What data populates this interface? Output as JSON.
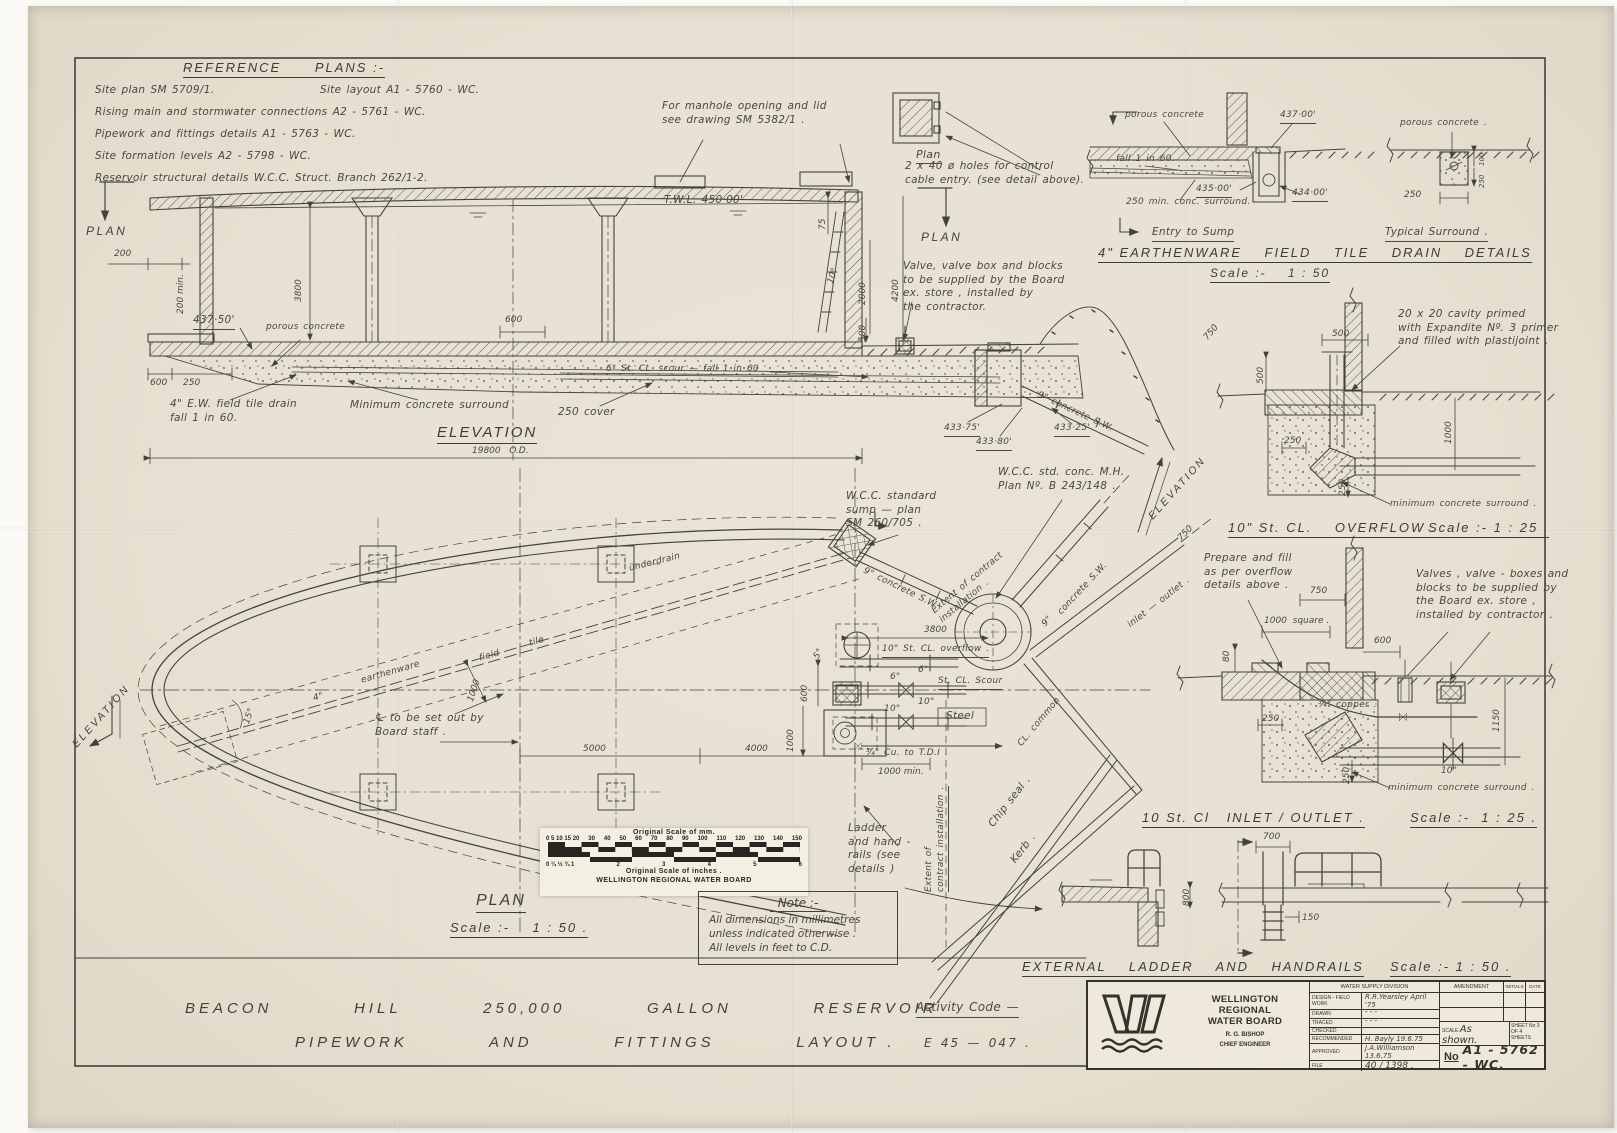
{
  "ref": {
    "title": "REFERENCE      PLANS :-",
    "r1a": "Site   plan      SM  5709/1.",
    "r1b": "Site   layout    A1 - 5760 - WC.",
    "r2": "Rising   main   and   stormwater   connections      A2 - 5761 - WC.",
    "r3": "Pipework   and   fittings   details      A1 - 5763 - WC.",
    "r4": "Site   formation   levels     A2 - 5798 - WC.",
    "r5": "Reservoir   structural   details     W.C.C.   Struct. Branch   262/1-2."
  },
  "top": {
    "manhole_note": "For  manhole  opening  and  lid\nsee  drawing  SM 5382/1 .",
    "plan_small": "Plan",
    "cable_note": "2 x 40 ø  holes  for  control\ncable  entry. (see  detail  above).",
    "plan_left": "PLAN",
    "plan_right": "PLAN"
  },
  "elev": {
    "twl": "T.W.L.   450·00'",
    "d200": "200",
    "d200min": "200 min.",
    "d3800": "3800",
    "lvl4375": "437·50'",
    "porous": "porous    concrete",
    "d600": "600",
    "d250": "250",
    "d600b": "600",
    "tile_note": "4\" E.W.  field  tile  drain\nfall    1 in 60.",
    "surround": "Minimum    concrete    surround",
    "cover": "250   cover",
    "scour": "6\"   St. CL.  scour  —  fall   1 in 60",
    "d75": "75",
    "d10": "10°",
    "d2000": "2000",
    "d4200": "4200",
    "d500": "500",
    "valve_note": "Valve, valve box  and  blocks\nto  be  supplied  by  the  Board\nex.  store ,  installed  by\nthe   contractor.",
    "l43375": "433·75'",
    "l43380": "433·80'",
    "l43325": "433·25'",
    "sw9": "9\" concrete  S.W.",
    "title": "ELEVATION",
    "od": "19800   O.D."
  },
  "tile": {
    "porous1": "porous  concrete",
    "l437": "437·00'",
    "fall": "fall 1 in 60",
    "l435": "435·00'",
    "surround": "250 min. conc. surround.",
    "l434": "434·00'",
    "d250": "250",
    "porous2": "porous  concrete .",
    "d100": "100",
    "d250b": "250",
    "entry": "Entry   to   Sump",
    "typical": "Typical    Surround .",
    "title": "4\" EARTHENWARE    FIELD    TILE    DRAIN    DETAILS",
    "scale": "Scale :-    1 : 50"
  },
  "mh": {
    "sump": "W.C.C.   standard\nsump  —  plan\nSM 260/705 .",
    "mh": "W.C.C.    std.   conc. M.H.\nPlan   Nº.  B 243/148 ."
  },
  "ovf": {
    "cavity": "20  x  20  cavity  primed\nwith  Expandite  Nº. 3  primer\nand  filled  with  plastijoint .",
    "d500h": "500",
    "d500v": "500",
    "d250": "250",
    "d1000": "1000",
    "d250v": "250",
    "surround": "minimum   concrete   surround .",
    "title": "10\" St. CL.    OVERFLOW .",
    "scale": "Scale :- 1 : 25 ."
  },
  "inl": {
    "prepare": "Prepare  and  fill\nas  per  overflow\ndetails  above .",
    "d750": "750",
    "d1000sq": "1000  square .",
    "d80": "80",
    "d600": "600",
    "valves": "Valves ,  valve - boxes  and\nblocks  to  be  supplied  by\nthe  Board  ex.  store ,\ninstalled  by  contractor .",
    "copper": "¾\"  copper .",
    "d250": "250",
    "d1150": "1150",
    "d10": "10\"",
    "d250v": "250",
    "surround": "minimum   concrete   surround .",
    "title": "10 St. Cl   INLET / OUTLET .",
    "scale": "Scale :-  1 : 25 ."
  },
  "lad": {
    "d700": "700",
    "d800": "800",
    "d150": "150",
    "title": "EXTERNAL    LADDER    AND    HANDRAILS",
    "scale": "Scale :- 1 : 50 ."
  },
  "plan": {
    "underdrain": "underdrain",
    "t4": "4\"",
    "earthenware": "earthenware",
    "field": "field",
    "tile": "tile",
    "d15": "15°",
    "d1000t": "1000",
    "clnote": "℄ to be  set  out  by\nBoard   staff .",
    "d5000": "5000",
    "d4000": "4000",
    "d3800": "3800",
    "elev_l": "ELEVATION",
    "elev_r": "ELEVATION",
    "sw9": "9\"",
    "sw9b": "concrete   S.W.",
    "sw9diag": "9\"  concrete  S.W.",
    "extent1": "Extent  of  contract\ninstallation .",
    "inlet": "inlet  —  outlet .",
    "overflow": "10\" St. CL. overflow .",
    "s6a": "6\"",
    "s6b": "6\"",
    "scour": "St. CL.   Scour",
    "s10a": "10\"",
    "s10b": "10\"",
    "steel": "Steel",
    "cu": "¾\"  Cu.    to    T.D.I .",
    "d1000min": "1000 min.",
    "d5": "5°",
    "d600": "600",
    "d1000": "1000",
    "ladder": "Ladder\nand  hand -\nrails (see\ndetails )",
    "extent2": "Extent  of\ncontract  installation .",
    "chip": "Chip    seal .",
    "kerb": "Kerb .",
    "common": "CL.   common",
    "d750a": "750",
    "d750b": "750",
    "title": "PLAN",
    "scale": "Scale :-    1 : 50 ."
  },
  "bar": {
    "mm_title": "Original    Scale  of  mm.",
    "mm": [
      "0 5 10 15 20",
      "30",
      "40",
      "50",
      "60",
      "70",
      "80",
      "90",
      "100",
      "110",
      "120",
      "130",
      "140",
      "150"
    ],
    "in_title": "Original   Scale  of  inches .",
    "inch": [
      "0  ¼  ½  ¾  1",
      "2",
      "3",
      "4",
      "5",
      "6"
    ],
    "org": "WELLINGTON  REGIONAL  WATER  BOARD"
  },
  "note": {
    "title": "Note :-",
    "l1": "All   dimensions   in   millimetres",
    "l2": "unless   indicated   otherwise .",
    "l3": "All  levels  in  feet  to  C.D."
  },
  "strip": {
    "line1": "BEACON          HILL          250,000          GALLON          RESERVOIR",
    "line2": "PIPEWORK          AND          FITTINGS          LAYOUT .",
    "activity": "Activity    Code  —",
    "code": "E 45 — 047 ."
  },
  "tb": {
    "org1": "WELLINGTON REGIONAL",
    "org2": "WATER BOARD",
    "eng1": "R. G. BISHOP",
    "eng2": "CHIEF ENGINEER",
    "division": "WATER SUPPLY DIVISION",
    "rows": [
      {
        "l": "DESIGN - FIELD WORK",
        "v": "R.R.Yearsley  April '75"
      },
      {
        "l": "DRAWN",
        "v": "″      ″      ″"
      },
      {
        "l": "TRACED",
        "v": "″      ″      ″"
      },
      {
        "l": "CHECKED",
        "v": ""
      },
      {
        "l": "RECOMMENDED",
        "v": "H. Bayly   19.6.75"
      },
      {
        "l": "APPROVED",
        "v": "J.A.Williamson  13.6.75"
      }
    ],
    "file_l": "FILE",
    "file_v": "40 / 1398 .",
    "amendment": "AMENDMENT",
    "initials": "INITIALS",
    "date": "DATE",
    "scale_l": "SCALE",
    "scale_v": "As  shown.",
    "sheet": "SHEET No  3\nOF  4   SHEETS",
    "no_l": "No",
    "no_v": "A1 - 5762 - WC."
  }
}
